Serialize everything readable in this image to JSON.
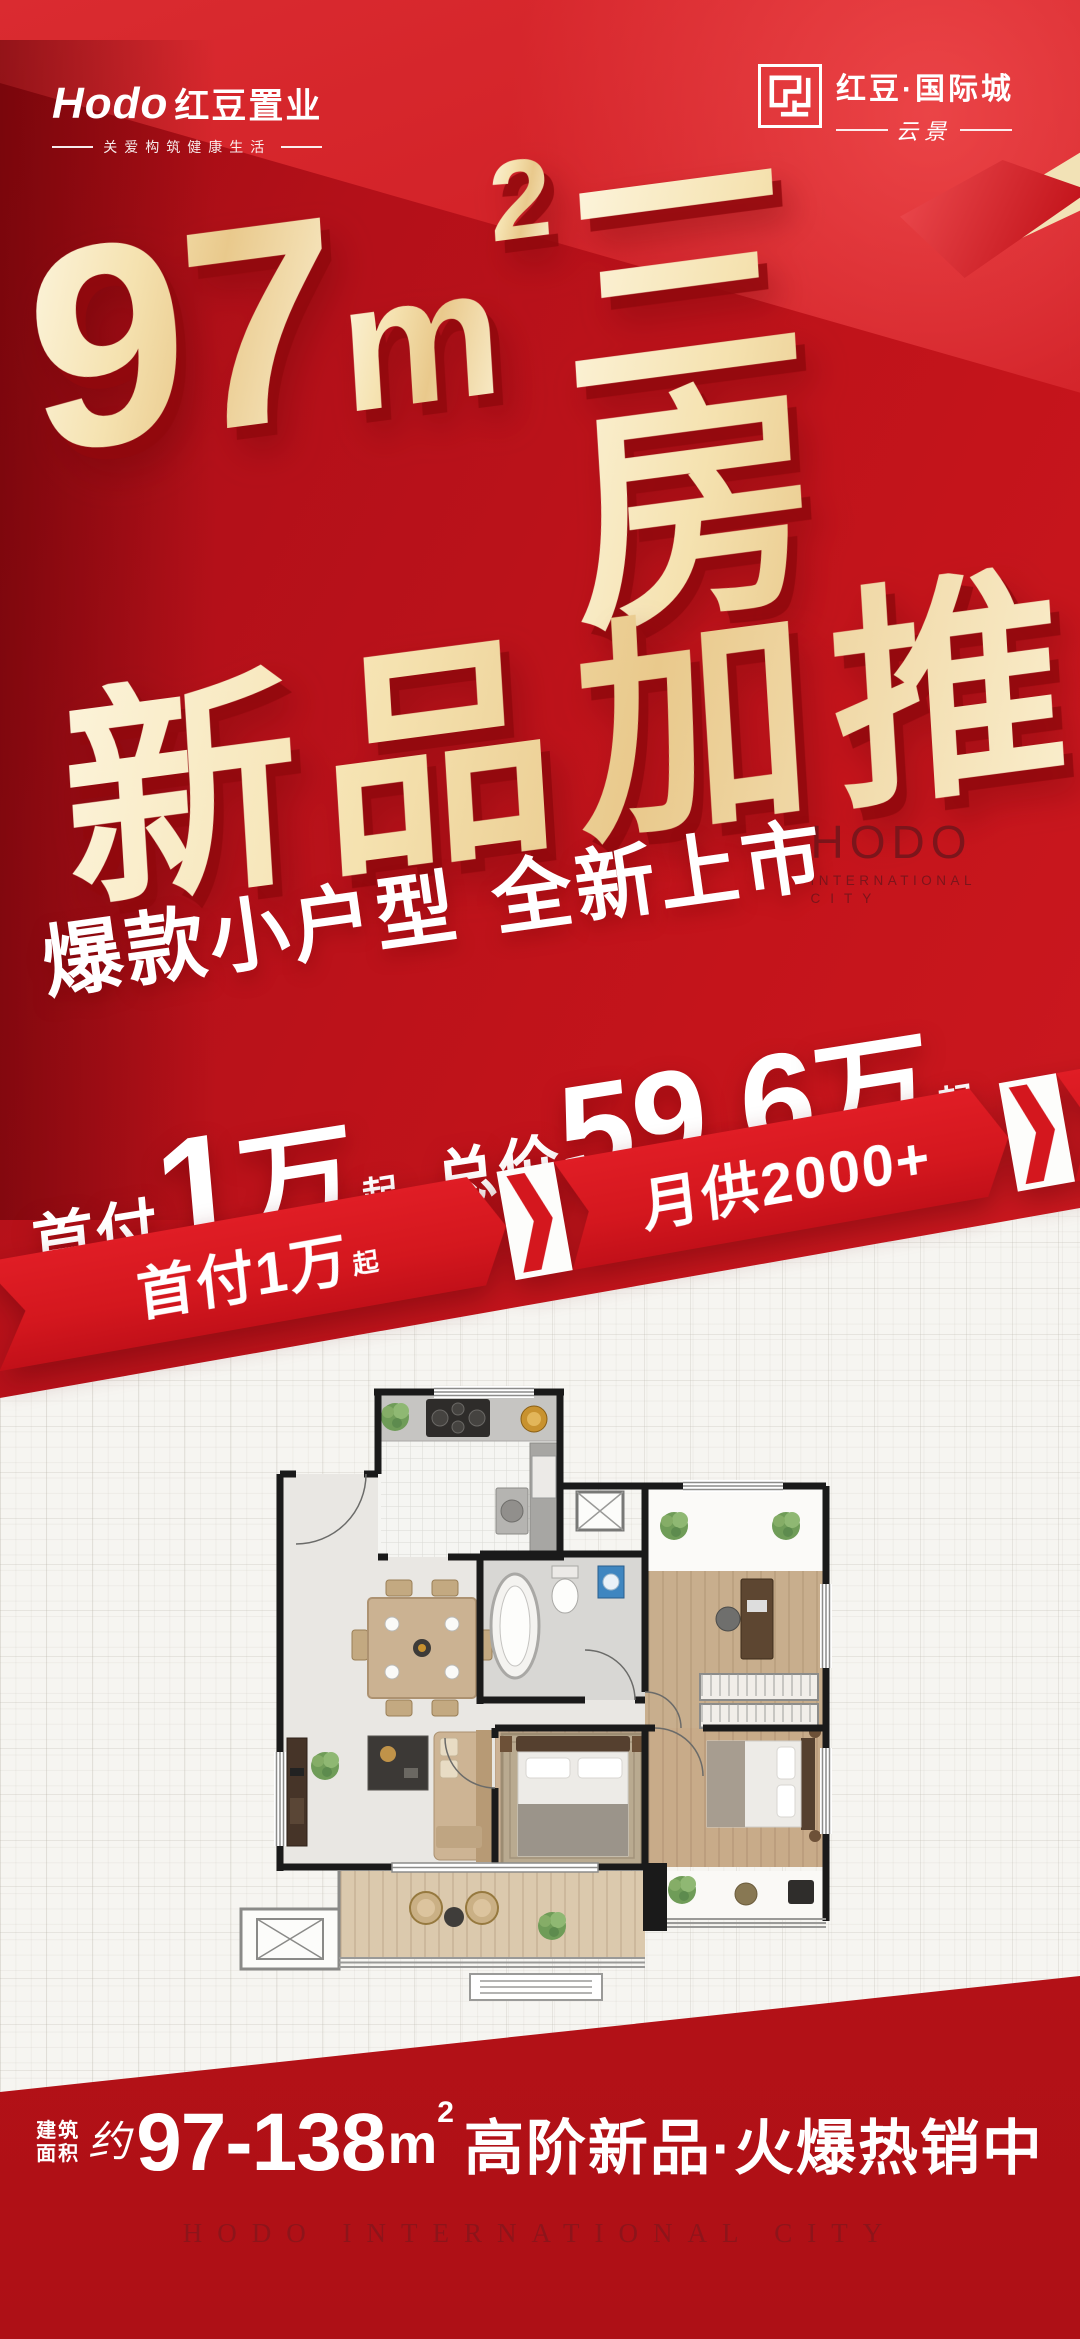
{
  "header": {
    "left": {
      "latin": "Hodo",
      "cn": "红豆置业",
      "tagline": "关爱构筑健康生活"
    },
    "right": {
      "name": "红豆·国际城",
      "sub": "云景"
    }
  },
  "hero": {
    "num": "97",
    "unit": "m",
    "sup": "2",
    "rooms": "三房",
    "line2": "新品加推"
  },
  "watermark": {
    "l1": "HODO",
    "l2": "INTERNATIONAL",
    "l3": "CITY"
  },
  "slogan": {
    "p1": "爆款小户型",
    "p2": "全新上市"
  },
  "price": {
    "label1": "首付",
    "num1": "1",
    "unit1": "万",
    "qi1": "起",
    "label2": "总价",
    "num2": "59.6",
    "unit2": "万",
    "qi2": "起"
  },
  "ribbon": {
    "items": [
      {
        "label": "首付1万",
        "suffix": "起"
      },
      {
        "label": "月供2000+",
        "suffix": ""
      },
      {
        "label": "园林实景房",
        "suffix": ""
      }
    ]
  },
  "bottom": {
    "area1": "建筑",
    "area2": "面积",
    "approx": "约",
    "range": "97-138",
    "unit": "m",
    "sup": "2",
    "tagline": "高阶新品·火爆热销中",
    "footer": "HODO INTERNATIONAL CITY"
  },
  "colors": {
    "primary_red": "#c4151c",
    "dark_red": "#9c0b11",
    "ribbon_red": "#d4171e",
    "gold": "#f3dfae",
    "cream": "#fdf3d6",
    "white_bg": "#f6f5f1"
  }
}
